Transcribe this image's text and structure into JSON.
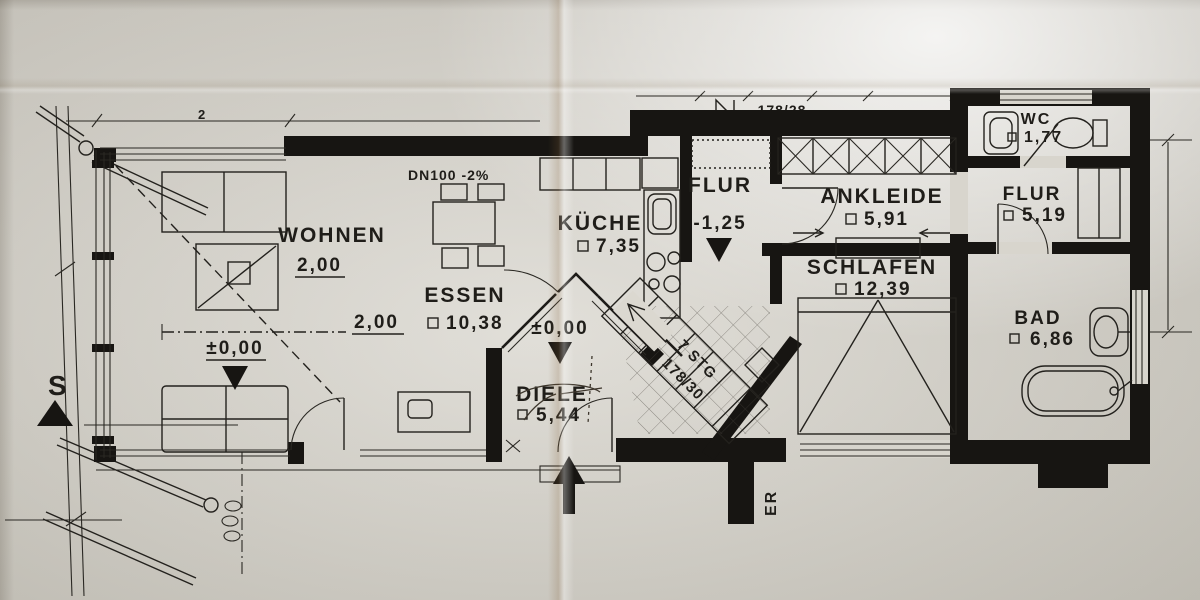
{
  "plan_title": "apartment-floor-plan-scan",
  "rooms": [
    {
      "id": "wohnen",
      "label": "WOHNEN",
      "area": "2,00"
    },
    {
      "id": "essen",
      "label": "ESSEN",
      "area": "10,38"
    },
    {
      "id": "kueche",
      "label": "KÜCHE",
      "area": "7,35"
    },
    {
      "id": "flur-mitte",
      "label": "FLUR",
      "level": "-1,25"
    },
    {
      "id": "diele",
      "label": "DIELE",
      "area": "5,44"
    },
    {
      "id": "ankleide",
      "label": "ANKLEIDE",
      "area": "5,91"
    },
    {
      "id": "schlafen",
      "label": "SCHLAFEN",
      "area": "12,39"
    },
    {
      "id": "wc",
      "label": "WC",
      "area": "1,77"
    },
    {
      "id": "flur-rechts",
      "label": "FLUR",
      "area": "5,19"
    },
    {
      "id": "bad",
      "label": "BAD",
      "area": "6,86"
    }
  ],
  "levels": {
    "zero": "±0,00",
    "height_line": "2,00"
  },
  "notes": {
    "drain": "DN100 -2%",
    "stairs_count": "7 STG",
    "stairs_dim": "178/30",
    "top_dim": "178/28",
    "south": "S",
    "edge": "ER",
    "partial_dim": "2"
  }
}
